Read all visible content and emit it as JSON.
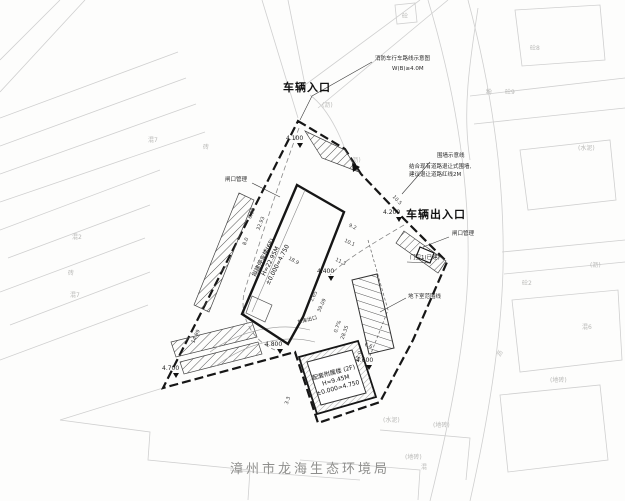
{
  "title": {
    "agency": "漳州市龙海生态环境局"
  },
  "entrances": {
    "north": "车辆入口",
    "east": "车辆出入口"
  },
  "notes": {
    "fire1": "消防车行车路线示意图",
    "fire2": "W(B)≥4.0M",
    "fence1": "围墙示意线",
    "fence2": "结合现有道路退让式围墙,",
    "fence3": "建议退让道路红线2M",
    "gate_left": "闸口管理",
    "gate_right": "闸口管理",
    "guard": "门卫1(已建)",
    "basement_line": "地下室范围线",
    "garage_exit": "车库出口"
  },
  "buildings": {
    "main": {
      "l1": "拟建停车楼(6F)",
      "l2": "H=22.95M",
      "l3": "±0.000=4.750"
    },
    "annex": {
      "l1": "配套附属楼 (2F)",
      "l2": "H=9.45M",
      "l3": "±0.000=4.750"
    }
  },
  "elevations": [
    {
      "v": "4.100"
    },
    {
      "v": "4.200"
    },
    {
      "v": "4.400"
    },
    {
      "v": "4.600"
    },
    {
      "v": "4.800"
    },
    {
      "v": "4.700"
    }
  ],
  "dims": [
    "8.0",
    "18.9",
    "9.2",
    "10.1",
    "11.3",
    "6.98",
    "32.93",
    "6.6",
    "11.0",
    "3.3",
    "1.65",
    "39.09",
    "0.7%",
    "28.35",
    "10.5",
    "14.99"
  ],
  "bg_labels": [
    "混7",
    "砖",
    "混2",
    "砖",
    "混7",
    "砼8",
    "砼9",
    "粉",
    "(水泥)",
    "(沥)",
    "砼2",
    "混6",
    "沥",
    "(地砖)",
    "(水泥)",
    "(地砖)",
    "(地砖)",
    "混",
    "(沥)",
    "(沥)",
    "砼"
  ]
}
